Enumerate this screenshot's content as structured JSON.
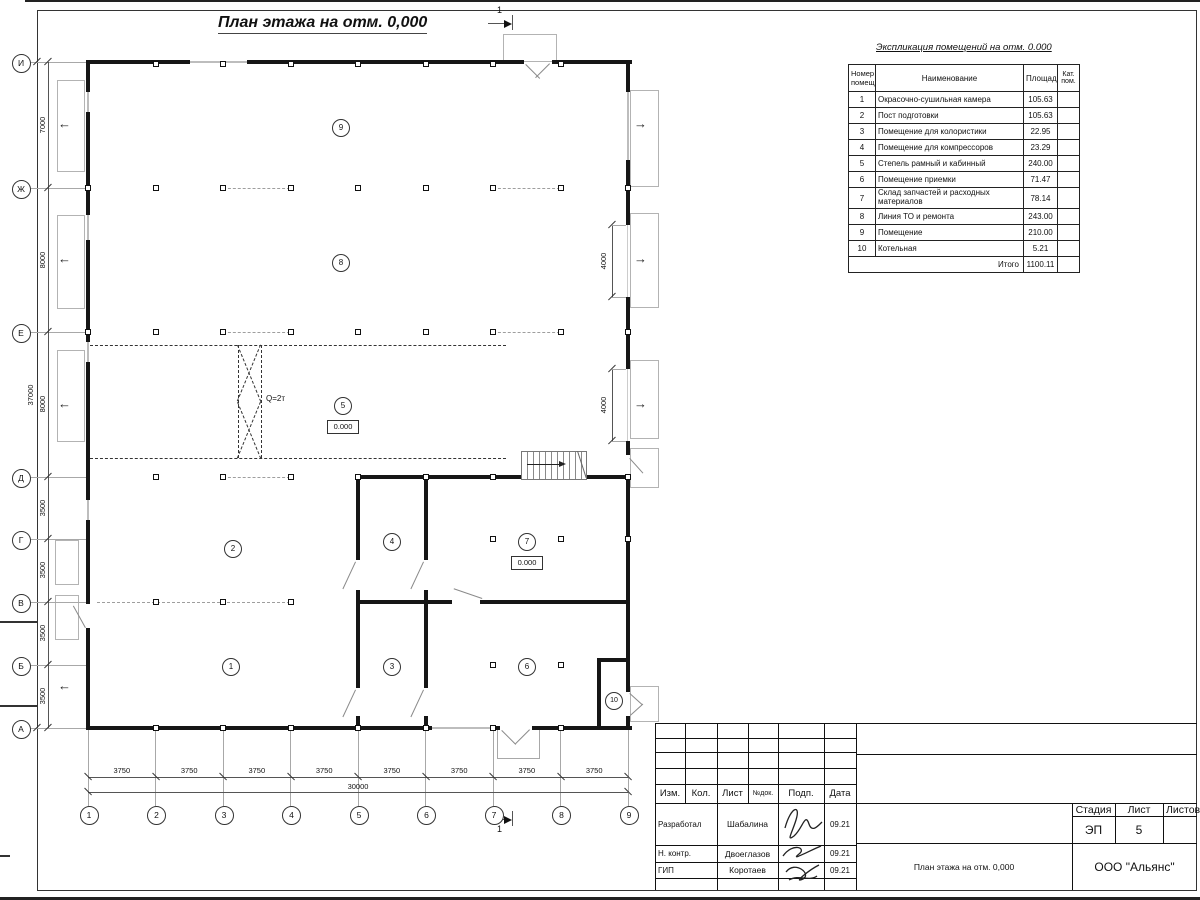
{
  "title": "План этажа на отм. 0,000",
  "section_label": "1",
  "plan": {
    "axes_rows": [
      "И",
      "Ж",
      "Е",
      "Д",
      "Г",
      "В",
      "Б",
      "А"
    ],
    "axes_cols": [
      "1",
      "2",
      "3",
      "4",
      "5",
      "6",
      "7",
      "8",
      "9"
    ],
    "dims_left": [
      "7000",
      "8000",
      "8000",
      "3500",
      "3500",
      "3500",
      "3500"
    ],
    "dim_left_total": "37000",
    "dims_bottom": [
      "3750",
      "3750",
      "3750",
      "3750",
      "3750",
      "3750",
      "3750",
      "3750"
    ],
    "dim_bottom_total": "30000",
    "dim_gate_1": "4000",
    "dim_gate_2": "4000",
    "rooms": [
      "1",
      "2",
      "3",
      "4",
      "5",
      "6",
      "7",
      "8",
      "9",
      "10"
    ],
    "elevation_hall": "0.000",
    "elevation_room7": "0.000",
    "crane_label": "Q=2т",
    "exit_arrow_left": "←",
    "exit_arrow_right": "→"
  },
  "explication": {
    "title": "Экспликация помещений на отм. 0.000",
    "col_num": "Номер помещ.",
    "col_name": "Наименование",
    "col_area": "Площадь",
    "col_cat": "Кат. пом.",
    "rows": [
      {
        "num": "1",
        "name": "Окрасочно-сушильная камера",
        "area": "105.63"
      },
      {
        "num": "2",
        "name": "Пост подготовки",
        "area": "105.63"
      },
      {
        "num": "3",
        "name": "Помещение для колористики",
        "area": "22.95"
      },
      {
        "num": "4",
        "name": "Помещение для компрессоров",
        "area": "23.29"
      },
      {
        "num": "5",
        "name": "Степель рамный и кабинный",
        "area": "240.00"
      },
      {
        "num": "6",
        "name": "Помещение приемки",
        "area": "71.47"
      },
      {
        "num": "7",
        "name": "Склад запчастей и расходных материалов",
        "area": "78.14"
      },
      {
        "num": "8",
        "name": "Линия ТО и ремонта",
        "area": "243.00"
      },
      {
        "num": "9",
        "name": "Помещение",
        "area": "210.00"
      },
      {
        "num": "10",
        "name": "Котельная",
        "area": "5.21"
      }
    ],
    "total_label": "Итого",
    "total_value": "1100.11"
  },
  "titleblock": {
    "col_izm": "Изм.",
    "col_kol": "Кол.",
    "col_list": "Лист",
    "col_ndok": "№док.",
    "col_podp": "Подп.",
    "col_data": "Дата",
    "row1_role": "Разработал",
    "row1_name": "Шабалина",
    "row1_date": "09.21",
    "row2_role": "Н. контр.",
    "row2_name": "Двоеглазов",
    "row2_date": "09.21",
    "row3_role": "ГИП",
    "row3_name": "Коротаев",
    "row3_date": "09.21",
    "stage_label": "Стадия",
    "sheet_label": "Лист",
    "sheets_label": "Листов",
    "stage_value": "ЭП",
    "sheet_value": "5",
    "doc_name": "План этажа на отм. 0,000",
    "company": "ООО \"Альянс\""
  }
}
